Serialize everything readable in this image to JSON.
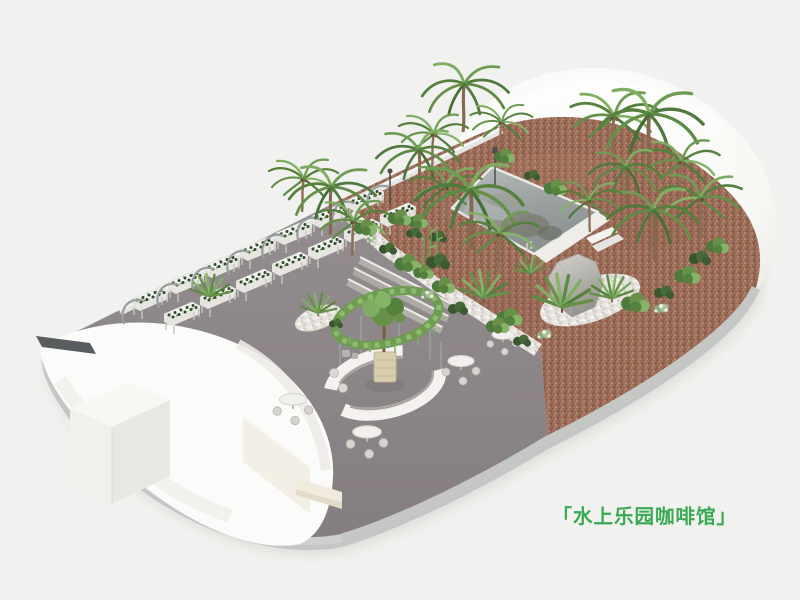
{
  "caption": {
    "text": "「水上乐园咖啡馆」",
    "color": "#3aa953"
  },
  "palette": {
    "background": "#f1f1ef",
    "structure_white": "#fbfbf9",
    "floor_gray": "#8d8689",
    "terracotta": "#9c6d5a",
    "pool_water": "#99a09f",
    "pebble_white": "#e7e4df",
    "foliage_green": "#679149",
    "rim_gray": "#c5c7c5",
    "caption_green": "#3aa953"
  },
  "scene": {
    "type": "isometric-3d-render",
    "elements": [
      {
        "name": "dome-canopy",
        "label": "translucent dome canopy"
      },
      {
        "name": "barrel-vault",
        "label": "white barrel-vault shell"
      },
      {
        "name": "entrance-cube",
        "label": "white entrance cube"
      },
      {
        "name": "reflecting-pool",
        "label": "square reflecting pool"
      },
      {
        "name": "palm-trees",
        "label": "palm trees"
      },
      {
        "name": "fan-palms",
        "label": "fan palms"
      },
      {
        "name": "shrub-beds",
        "label": "shrubs and ground cover"
      },
      {
        "name": "pebble-strip",
        "label": "white pebble strip"
      },
      {
        "name": "boulder",
        "label": "gray boulder"
      },
      {
        "name": "hydroponic-planters",
        "label": "hooped planter benches"
      },
      {
        "name": "circular-bar",
        "label": "circular bar with vine ring"
      },
      {
        "name": "cafe-tables",
        "label": "round cafe tables with chairs"
      }
    ],
    "counts": {
      "planter_rows": 2,
      "planter_boxes": 14,
      "hoops": 8,
      "cafe_tables": 4
    }
  }
}
